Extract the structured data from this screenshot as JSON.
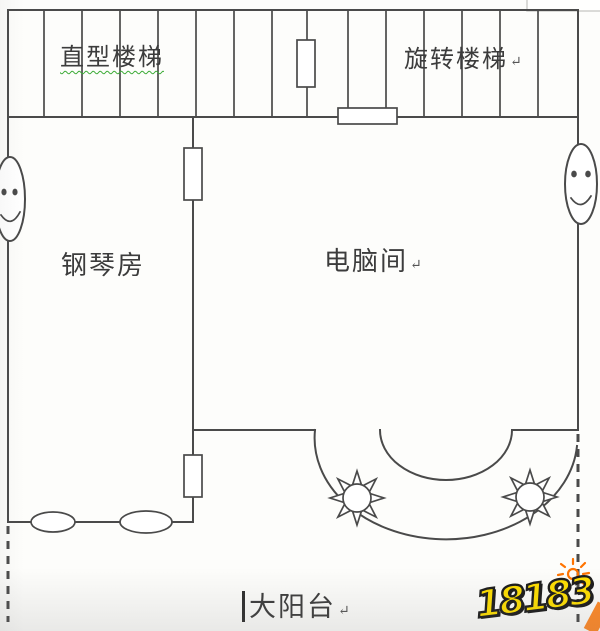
{
  "rooms": {
    "straight_staircase": "直型楼梯",
    "spiral_staircase": "旋转楼梯",
    "piano_room": "钢琴房",
    "computer_room": "电脑间",
    "balcony": "大阳台"
  },
  "marks": {
    "return_mark": "↵"
  },
  "watermark": {
    "text": "18183"
  },
  "colors": {
    "wall": "#4a4a4a",
    "text": "#3c3c3c",
    "squiggle": "#3aaa35",
    "logo_fill": "#ffdf00",
    "logo_outline": "#1b1b1b",
    "logo_sun": "#ff7300"
  }
}
